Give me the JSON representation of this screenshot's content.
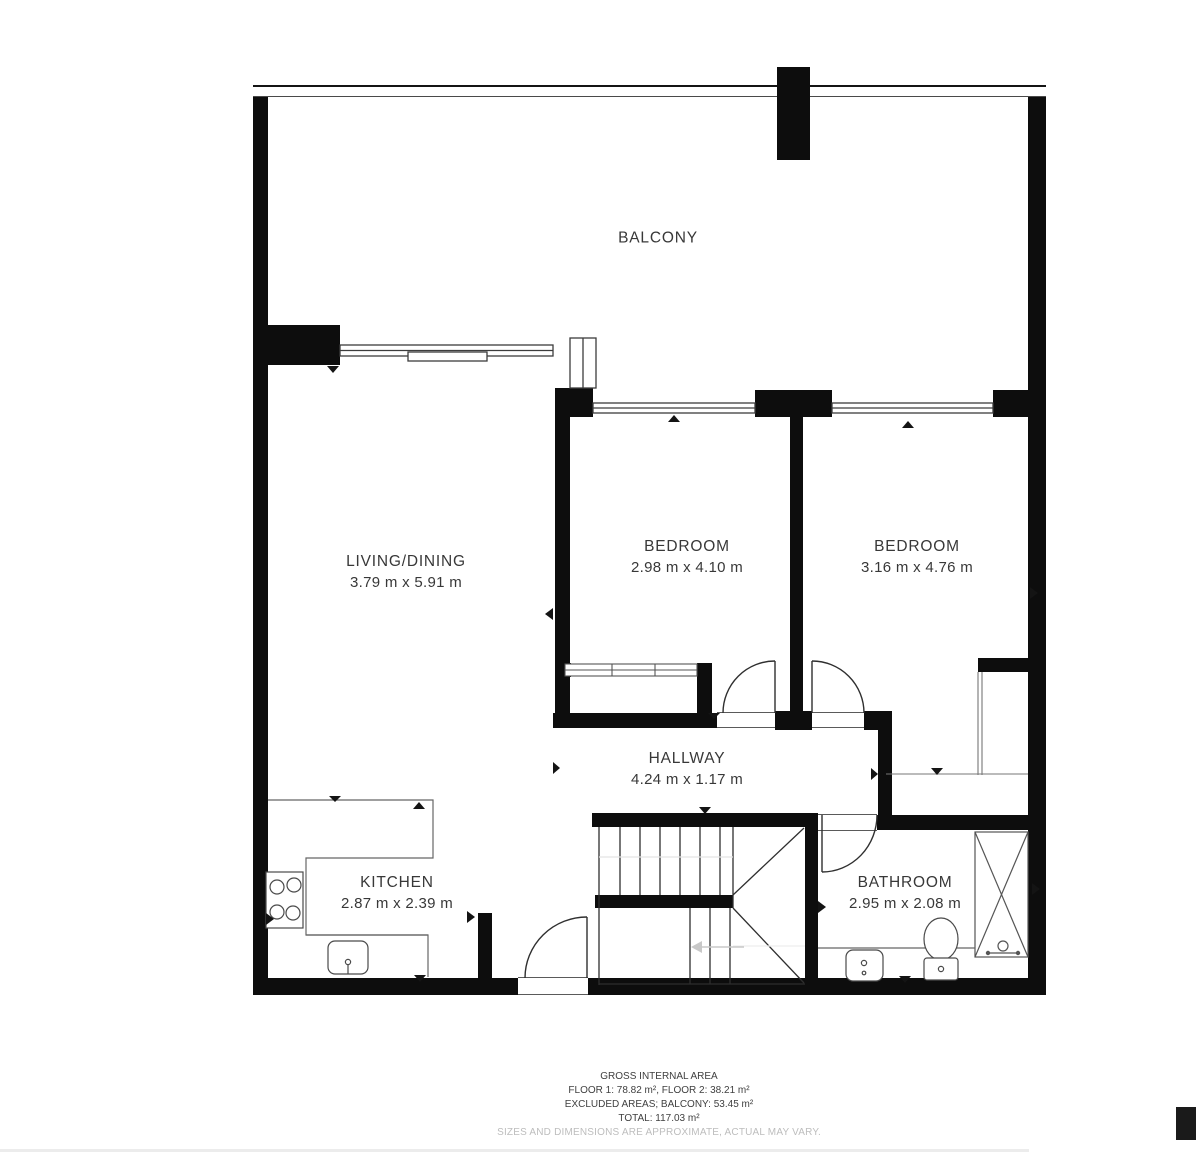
{
  "plan_title": "floor-plan",
  "rooms": {
    "balcony": {
      "name": "BALCONY",
      "dims": ""
    },
    "living": {
      "name": "LIVING/DINING",
      "dims": "3.79 m x 5.91 m"
    },
    "bedroom1": {
      "name": "BEDROOM",
      "dims": "2.98 m x 4.10 m"
    },
    "bedroom2": {
      "name": "BEDROOM",
      "dims": "3.16 m x 4.76 m"
    },
    "hallway": {
      "name": "HALLWAY",
      "dims": "4.24 m x 1.17 m"
    },
    "kitchen": {
      "name": "KITCHEN",
      "dims": "2.87 m x 2.39 m"
    },
    "bathroom": {
      "name": "BATHROOM",
      "dims": "2.95 m x 2.08 m"
    }
  },
  "footer": {
    "title": "GROSS INTERNAL AREA",
    "line1": "FLOOR 1: 78.82 m², FLOOR 2: 38.21 m²",
    "line2": "EXCLUDED AREAS; BALCONY: 53.45 m²",
    "line3": "TOTAL: 117.03 m²",
    "disclaimer": "SIZES AND DIMENSIONS ARE APPROXIMATE, ACTUAL MAY VARY."
  },
  "colors": {
    "wall": "#0d0d0d",
    "line": "#3c3c3c",
    "faint": "#c8c8c8"
  }
}
